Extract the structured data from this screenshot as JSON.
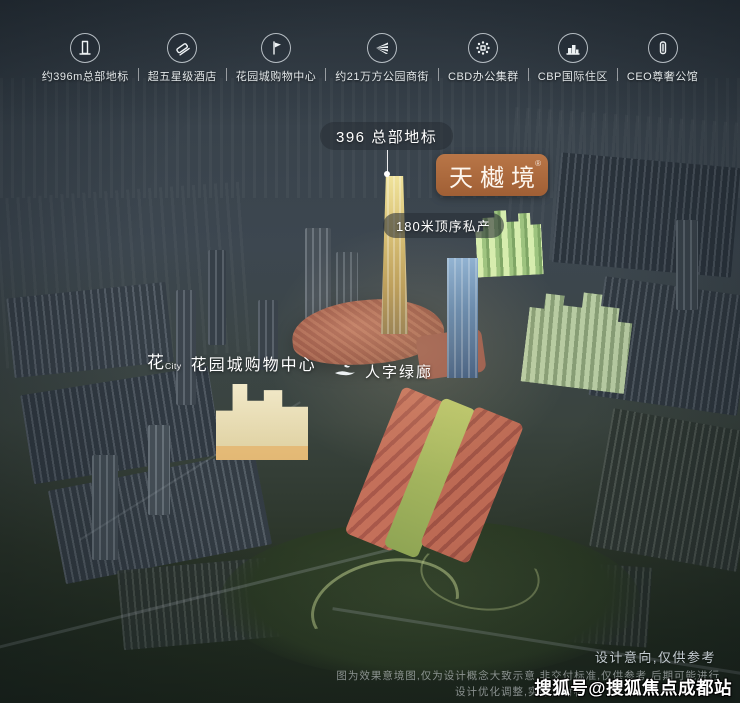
{
  "feature_bar": {
    "items": [
      {
        "icon": "tower-icon",
        "label": "约396m总部地标"
      },
      {
        "icon": "hotel-icon",
        "label": "超五星级酒店"
      },
      {
        "icon": "mall-icon",
        "label": "花园城购物中心"
      },
      {
        "icon": "park-street-icon",
        "label": "约21万方公园商街"
      },
      {
        "icon": "cbd-cluster-icon",
        "label": "CBD办公集群"
      },
      {
        "icon": "residence-icon",
        "label": "CBP国际住区"
      },
      {
        "icon": "mansion-icon",
        "label": "CEO尊奢公馆"
      }
    ]
  },
  "callouts": {
    "landmark": "396 总部地标",
    "brand": "天樾境",
    "brand_mark": "®",
    "top_private": "180米顶序私产",
    "mall_logo_cn": "花",
    "mall_logo_en": "City",
    "mall": "花园城购物中心",
    "corridor": "人字绿廊"
  },
  "footer": {
    "design_note": "设计意向,仅供参考",
    "disclaimer_1": "图为效果意境图,仅为设计概念大致示意,非交付标准,仅供参考,后期可能进行",
    "disclaimer_2": "设计优化调整,实际交付标",
    "watermark": "搜狐号@搜狐焦点成都站"
  },
  "colors": {
    "brand_bg": "#ad6a3e",
    "pill_bg": "rgba(40,47,53,0.58)",
    "gold_tower": "#d9c176",
    "blue_tower": "#5d82ab",
    "highlight_green": "#b9d694",
    "retail_red": "#a85a4a"
  }
}
